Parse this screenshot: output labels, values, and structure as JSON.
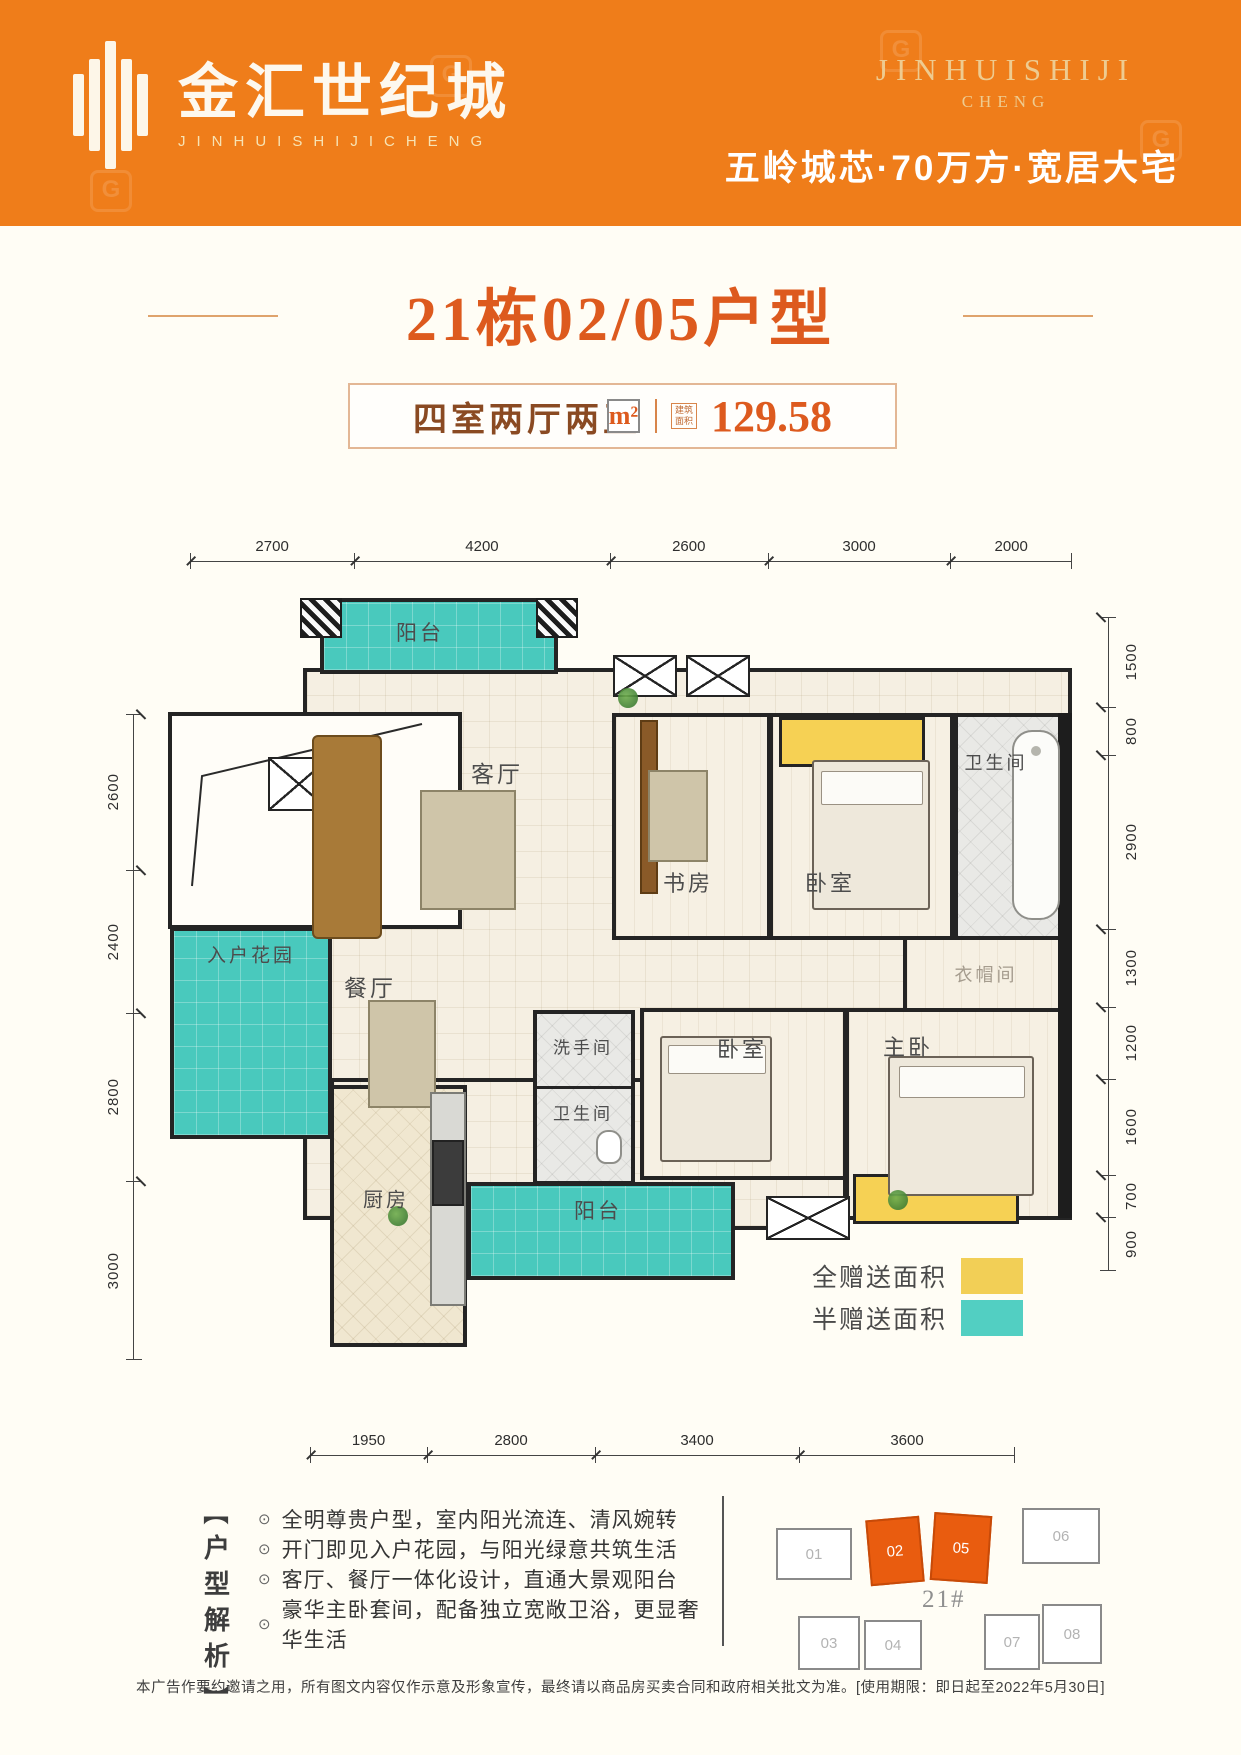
{
  "header": {
    "bg_color": "#ef7d1a",
    "logo": {
      "name": "金汇世纪城",
      "subtitle": "JINHUISHIJICHENG"
    },
    "brand": {
      "line1": "JINHUISHIJI",
      "line2": "CHENG"
    },
    "tagline": "五岭城芯·70万方·宽居大宅",
    "watermark_glyph": "G"
  },
  "title": {
    "text": "21栋02/05户型"
  },
  "badge": {
    "layout": "四室两厅两卫",
    "area_icon": "建筑面积",
    "value": "129.58",
    "unit": "m²"
  },
  "plan": {
    "dims": {
      "top": [
        "2700",
        "4200",
        "2600",
        "3000",
        "2000"
      ],
      "left": [
        "2600",
        "2400",
        "2800",
        "3000"
      ],
      "right": [
        "1500",
        "800",
        "2900",
        "1300",
        "1200",
        "1600",
        "700",
        "900"
      ],
      "bottom": [
        "1950",
        "2800",
        "3400",
        "3600"
      ]
    },
    "rooms": {
      "balcony_top": "阳台",
      "living": "客厅",
      "dining": "餐厅",
      "entry_garden": "入户花园",
      "study": "书房",
      "bedroom_top": "卧室",
      "bath_top": "卫生间",
      "cloakroom": "衣帽间",
      "master": "主卧",
      "bedroom_mid": "卧室",
      "washroom": "洗手间",
      "bath_mid": "卫生间",
      "balcony_bottom": "阳台",
      "kitchen": "厨房"
    },
    "legend": [
      {
        "label": "全赠送面积",
        "color": "#f6d154"
      },
      {
        "label": "半赠送面积",
        "color": "#52cfc2"
      }
    ]
  },
  "analysis": {
    "title": "户型解析",
    "bracket_top": "︻",
    "bracket_bottom": "︼",
    "bullet_icon": "⊙",
    "bullets": [
      "全明尊贵户型，室内阳光流连、清风婉转",
      "开门即见入户花园，与阳光绿意共筑生活",
      "客厅、餐厅一体化设计，直通大景观阳台",
      "豪华主卧套间，配备独立宽敞卫浴，更显奢华生活"
    ]
  },
  "site": {
    "building_no": "21#",
    "units": [
      {
        "no": "01",
        "highlight": false
      },
      {
        "no": "02",
        "highlight": true
      },
      {
        "no": "05",
        "highlight": true
      },
      {
        "no": "06",
        "highlight": false
      },
      {
        "no": "03",
        "highlight": false
      },
      {
        "no": "04",
        "highlight": false
      },
      {
        "no": "07",
        "highlight": false
      },
      {
        "no": "08",
        "highlight": false
      }
    ]
  },
  "disclaimer": {
    "text": "本广告作要约邀请之用，所有图文内容仅作示意及形象宣传，最终请以商品房买卖合同和政府相关批文为准。[使用期限：即日起至2022年5月30日]"
  }
}
